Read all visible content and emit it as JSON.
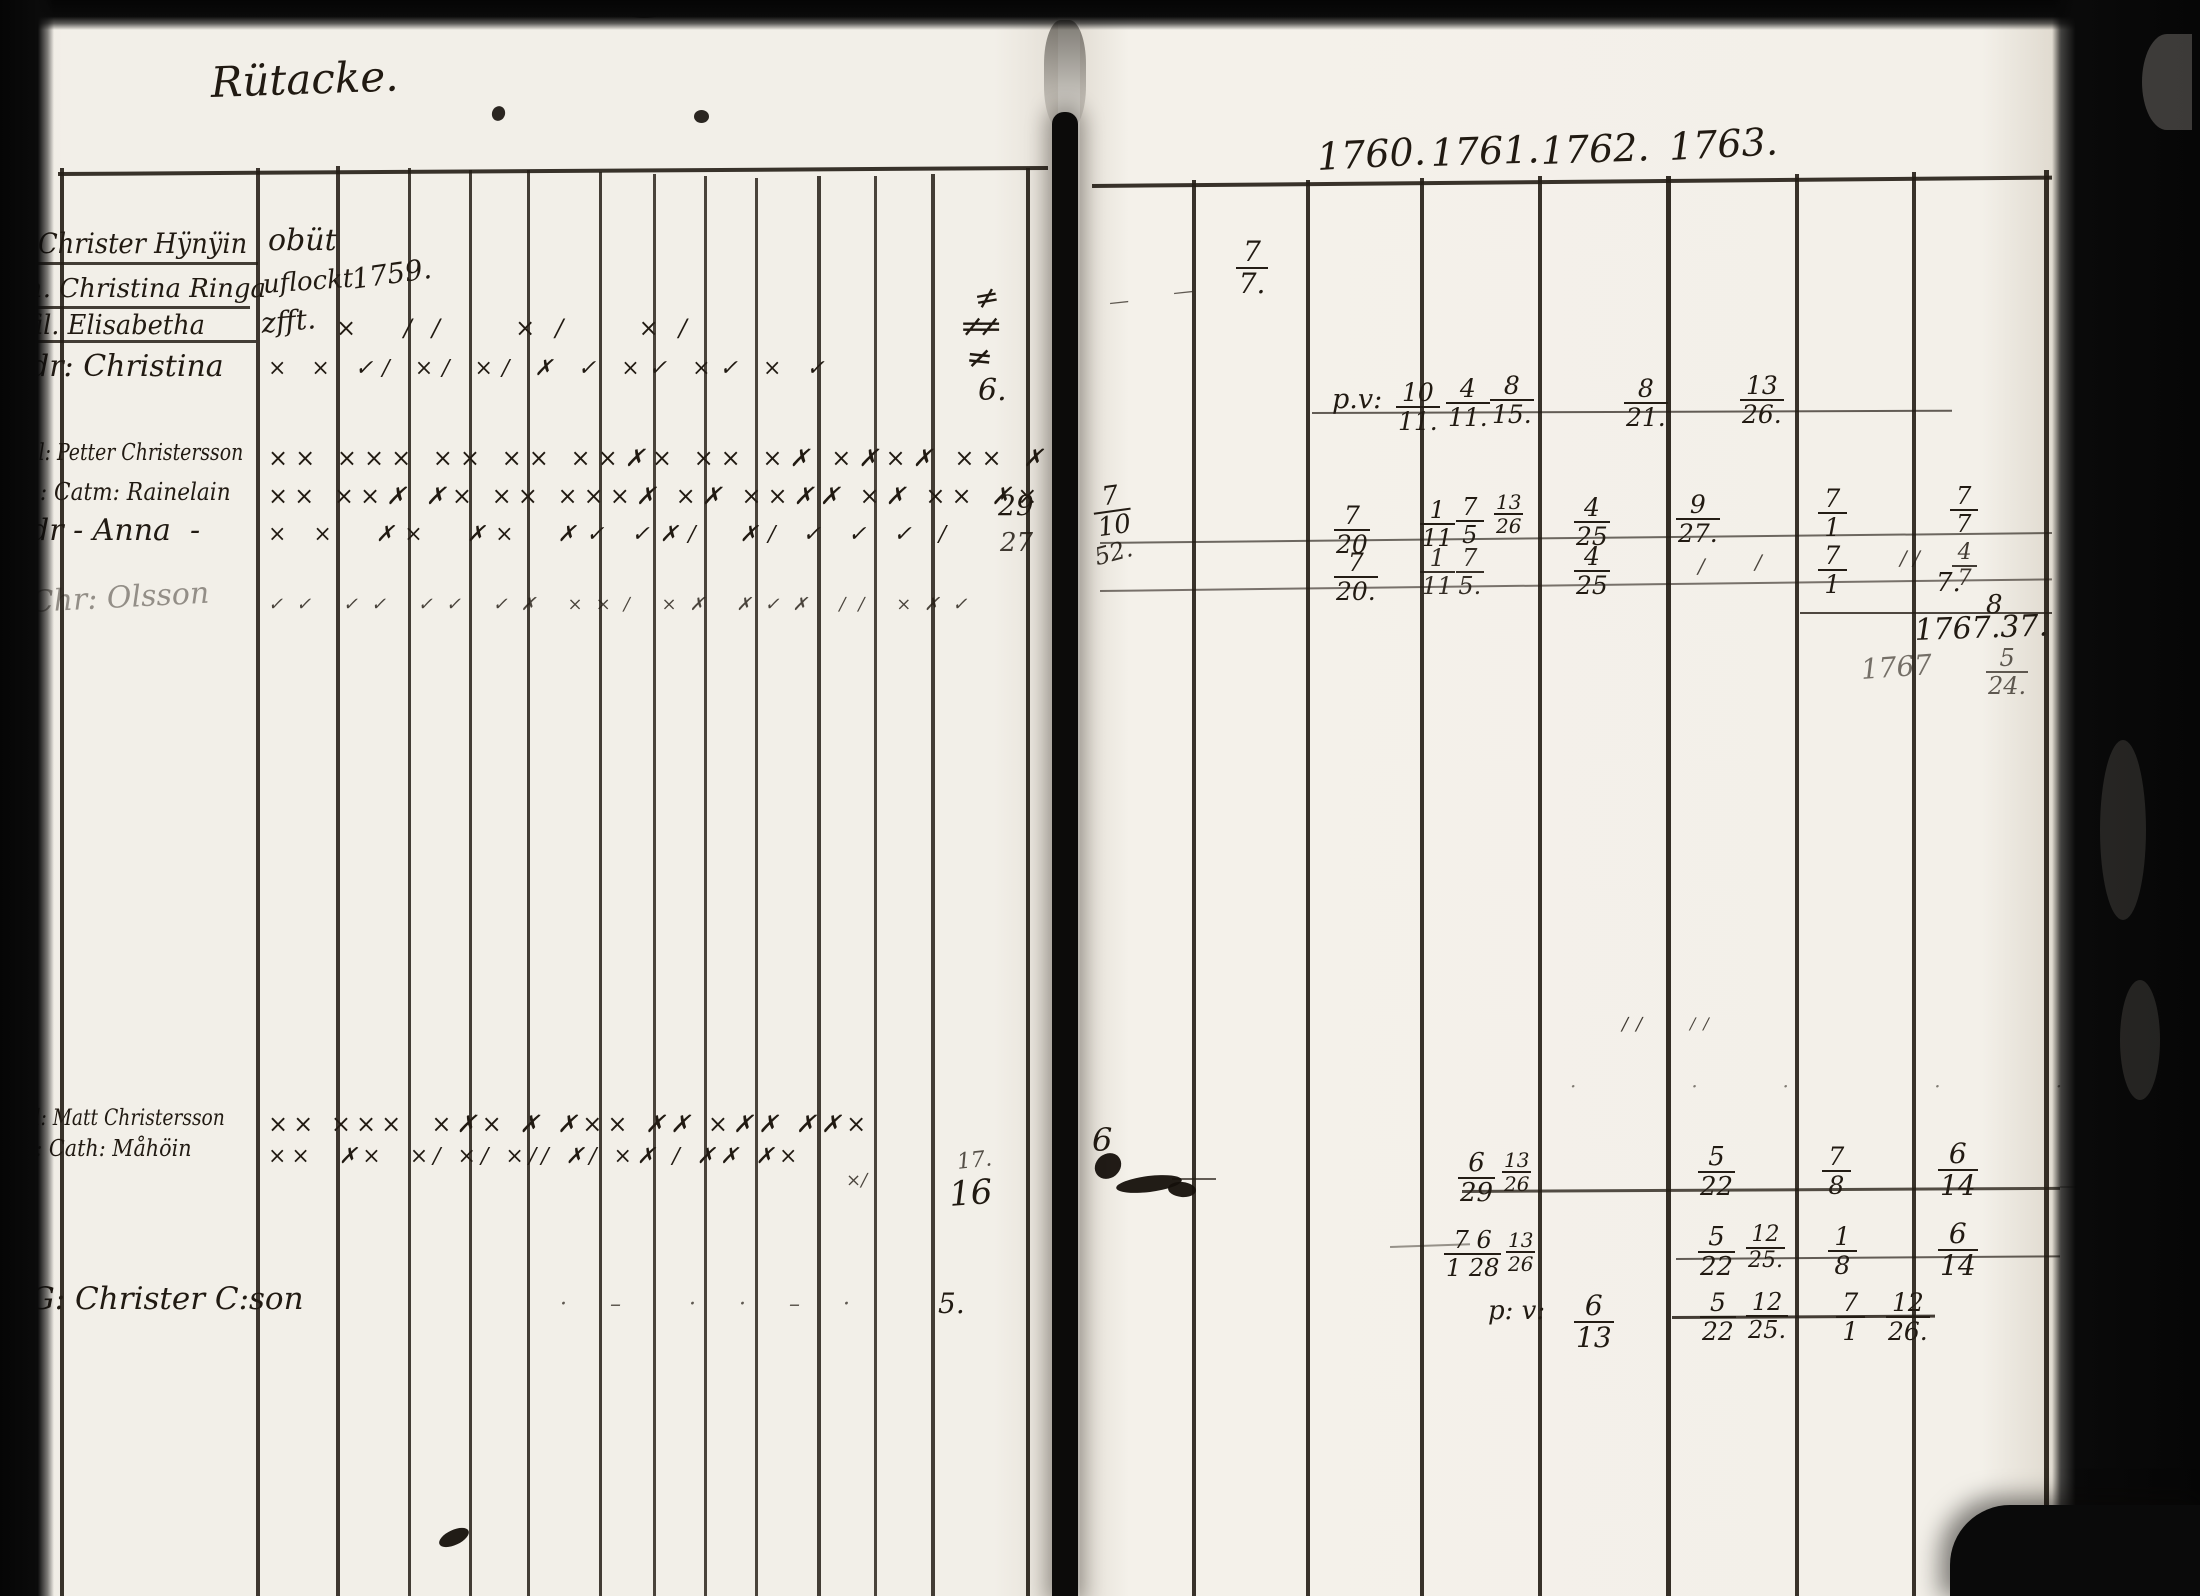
{
  "title": {
    "x": 210,
    "y": 62,
    "text": "Rütacke.",
    "size": 42,
    "rot": -2,
    "name": "page-title"
  },
  "years": [
    {
      "x": 1316,
      "y": 138,
      "text": "1760.",
      "size": 38,
      "rot": -3,
      "name": "year-label"
    },
    {
      "x": 1430,
      "y": 134,
      "text": "1761.",
      "size": 38,
      "rot": -2,
      "name": "year-label"
    },
    {
      "x": 1540,
      "y": 132,
      "text": "1762.",
      "size": 38,
      "rot": -2,
      "name": "year-label"
    },
    {
      "x": 1668,
      "y": 128,
      "text": "1763.",
      "size": 38,
      "rot": -3,
      "name": "year-label"
    }
  ],
  "left_page": {
    "records": [
      {
        "x": 38,
        "y": 230,
        "text": "Christer Hÿnÿin",
        "size": 28,
        "scx": 0.92,
        "name": "record-name"
      },
      {
        "x": 268,
        "y": 226,
        "text": "obüt",
        "size": 30,
        "name": "record-note"
      },
      {
        "x": 26,
        "y": 276,
        "text": "h. Christina Ringa",
        "size": 26,
        "name": "record-name"
      },
      {
        "x": 262,
        "y": 272,
        "text": "uflockt",
        "size": 26,
        "rot": -4,
        "name": "record-note"
      },
      {
        "x": 350,
        "y": 266,
        "text": "1759.",
        "size": 28,
        "rot": -8,
        "name": "record-note"
      },
      {
        "x": 26,
        "y": 312,
        "text": "fil. Elisabetha",
        "size": 27,
        "scx": 0.95,
        "name": "record-name"
      },
      {
        "x": 260,
        "y": 310,
        "text": "zfft.",
        "size": 28,
        "rot": -5,
        "name": "record-note"
      },
      {
        "x": 30,
        "y": 352,
        "text": "dr: Christina",
        "size": 30,
        "name": "record-name"
      },
      {
        "x": 26,
        "y": 442,
        "text": "fil: Petter Christersson",
        "size": 23,
        "scx": 0.82,
        "name": "record-name"
      },
      {
        "x": 26,
        "y": 480,
        "text": "h: Catm: Rainelain",
        "size": 24,
        "scx": 0.9,
        "name": "record-name"
      },
      {
        "x": 30,
        "y": 516,
        "text": "dr - Anna  -",
        "size": 30,
        "name": "record-name"
      },
      {
        "x": 30,
        "y": 588,
        "text": "Chr: Olsson",
        "size": 30,
        "o": 0.45,
        "rot": -3,
        "name": "record-name"
      },
      {
        "x": 22,
        "y": 1108,
        "text": "fil: Matt Christersson",
        "size": 22,
        "scx": 0.85,
        "name": "record-name"
      },
      {
        "x": 22,
        "y": 1138,
        "text": "h: Cath: Måhöin",
        "size": 23,
        "scx": 0.9,
        "name": "record-name"
      },
      {
        "x": 30,
        "y": 1284,
        "text": "G: Christer C:son",
        "size": 31,
        "name": "record-name"
      }
    ],
    "mark_rows": [
      {
        "x": 336,
        "y": 316,
        "text": "× ∕∕  ×∕  ×∕",
        "size": 24,
        "ls": 20,
        "name": "mark-row"
      },
      {
        "x": 268,
        "y": 358,
        "text": "× × ✓∕ ×∕ ×∕ ✗ ✓ ×✓ ×✓ × ✓",
        "size": 22,
        "ls": 9,
        "name": "mark-row"
      },
      {
        "x": 268,
        "y": 446,
        "text": "×× ××× ×× ×× ××✗× ×× ×✗ ×✗×✗ ×× ✗",
        "size": 24,
        "ls": 7,
        "name": "mark-row"
      },
      {
        "x": 268,
        "y": 484,
        "text": "×× ××✗ ✗× ×× ×××✗ ×✗ ××✗✗ ×✗ ×× ✗×",
        "size": 24,
        "ls": 6,
        "name": "mark-row"
      },
      {
        "x": 268,
        "y": 524,
        "text": "× ×  ✗×  ✗×  ✗✓ ✓✗∕  ✗∕ ✓ ✓ ✓ ∕",
        "size": 22,
        "ls": 10,
        "name": "mark-row"
      },
      {
        "x": 268,
        "y": 596,
        "text": "✓✓ ✓✓ ✓✓ ✓✗ ××∕ ×✗ ✗✓✗ ∕∕ ×✗✓",
        "size": 18,
        "ls": 13,
        "o": 0.8,
        "name": "mark-row"
      },
      {
        "x": 268,
        "y": 1112,
        "text": "×× ×××  ×✗× ✗ ✗×× ✗✗ ×✗✗ ✗✗×",
        "size": 24,
        "ls": 5,
        "name": "mark-row"
      },
      {
        "x": 268,
        "y": 1146,
        "text": "××  ✗×  ×∕ ×∕ ×∕∕ ✗∕ ×✗ ∕ ✗✗ ✗×",
        "size": 22,
        "ls": 5,
        "name": "mark-row"
      },
      {
        "x": 846,
        "y": 1172,
        "text": "×∕",
        "size": 18,
        "o": 0.8,
        "name": "mark-row"
      },
      {
        "x": 560,
        "y": 1294,
        "text": "· –  · · – ·",
        "size": 22,
        "ls": 18,
        "o": 0.7,
        "name": "mark-row"
      }
    ],
    "numbers": [
      {
        "x": 972,
        "y": 286,
        "text": "≠",
        "size": 30,
        "rot": -10,
        "name": "tally-mark"
      },
      {
        "x": 960,
        "y": 312,
        "text": "≠≠",
        "size": 30,
        "ls": -8,
        "name": "tally-mark"
      },
      {
        "x": 968,
        "y": 340,
        "text": "≠",
        "size": 32,
        "rot": 6,
        "name": "tally-mark"
      },
      {
        "x": 978,
        "y": 376,
        "text": "6.",
        "size": 30,
        "name": "number"
      },
      {
        "x": 998,
        "y": 492,
        "text": "29",
        "size": 28,
        "name": "number"
      },
      {
        "x": 1000,
        "y": 530,
        "text": "27",
        "size": 26,
        "o": 0.85,
        "name": "number"
      },
      {
        "x": 956,
        "y": 1152,
        "text": "17.",
        "size": 22,
        "o": 0.75,
        "rot": -6,
        "name": "number"
      },
      {
        "x": 948,
        "y": 1178,
        "text": "16",
        "size": 34,
        "rot": -4,
        "name": "number"
      },
      {
        "x": 938,
        "y": 1290,
        "text": "5.",
        "size": 28,
        "name": "number"
      }
    ]
  },
  "right_page": {
    "notes": [
      {
        "x": 1108,
        "y": 292,
        "text": "—",
        "size": 20,
        "rot": -6,
        "o": 0.7,
        "name": "pen-dash"
      },
      {
        "x": 1172,
        "y": 282,
        "text": "—",
        "size": 20,
        "rot": -6,
        "o": 0.7,
        "name": "pen-dash"
      },
      {
        "x": 1332,
        "y": 386,
        "text": "p.v:",
        "size": 27,
        "name": "abbrev-pv"
      },
      {
        "x": 1092,
        "y": 546,
        "text": "52.",
        "size": 24,
        "rot": -15,
        "o": 0.9,
        "name": "number"
      },
      {
        "x": 1698,
        "y": 556,
        "text": "∕",
        "size": 20,
        "o": 0.8,
        "name": "pen-tick"
      },
      {
        "x": 1755,
        "y": 552,
        "text": "∕",
        "size": 20,
        "o": 0.8,
        "name": "pen-tick"
      },
      {
        "x": 1900,
        "y": 548,
        "text": "∕ ∕",
        "size": 20,
        "o": 0.8,
        "name": "pen-tick"
      },
      {
        "x": 1936,
        "y": 570,
        "text": "7.",
        "size": 26,
        "name": "number"
      },
      {
        "x": 1986,
        "y": 592,
        "text": "8",
        "size": 26,
        "name": "number"
      },
      {
        "x": 1914,
        "y": 616,
        "text": "1767.37.",
        "size": 30,
        "rot": -2,
        "name": "year-total"
      },
      {
        "x": 1860,
        "y": 656,
        "text": "1767",
        "size": 28,
        "rot": -4,
        "o": 0.6,
        "name": "year-total"
      },
      {
        "x": 1622,
        "y": 1016,
        "text": "∕∕",
        "size": 18,
        "ls": 8,
        "o": 0.85,
        "name": "pen-tick"
      },
      {
        "x": 1690,
        "y": 1016,
        "text": "∕∕",
        "size": 16,
        "ls": 8,
        "o": 0.8,
        "name": "pen-tick"
      },
      {
        "x": 1570,
        "y": 1076,
        "text": "·   ·  ·    ·   ·  · ·",
        "size": 20,
        "ls": 24,
        "o": 0.55,
        "name": "dot-row"
      },
      {
        "x": 1092,
        "y": 1124,
        "text": "6",
        "size": 32,
        "name": "number"
      },
      {
        "x": 1488,
        "y": 1298,
        "text": "p: v:",
        "size": 26,
        "name": "abbrev-pv"
      }
    ],
    "fractions": [
      {
        "x": 1236,
        "y": 238,
        "num": "7",
        "den": "7.",
        "size": 28,
        "name": "date-fraction"
      },
      {
        "x": 1396,
        "y": 380,
        "num": "10",
        "den": "11.",
        "size": 25,
        "name": "date-fraction"
      },
      {
        "x": 1446,
        "y": 376,
        "num": "4",
        "den": "11.",
        "size": 25,
        "name": "date-fraction"
      },
      {
        "x": 1490,
        "y": 373,
        "num": "8",
        "den": "15.",
        "size": 25,
        "name": "date-fraction"
      },
      {
        "x": 1624,
        "y": 376,
        "num": "8",
        "den": "21.",
        "size": 25,
        "name": "date-fraction"
      },
      {
        "x": 1740,
        "y": 373,
        "num": "13",
        "den": "26.",
        "size": 25,
        "name": "date-fraction"
      },
      {
        "x": 1090,
        "y": 486,
        "num": "7",
        "den": "10",
        "size": 26,
        "rot": -8,
        "name": "date-fraction"
      },
      {
        "x": 1334,
        "y": 503,
        "num": "7",
        "den": "20",
        "size": 25,
        "name": "date-fraction"
      },
      {
        "x": 1420,
        "y": 498,
        "num": "1",
        "den": "11",
        "size": 24,
        "name": "date-fraction"
      },
      {
        "x": 1456,
        "y": 495,
        "num": "7",
        "den": "5",
        "size": 24,
        "name": "date-fraction"
      },
      {
        "x": 1494,
        "y": 492,
        "num": "13",
        "den": "26",
        "size": 20,
        "name": "date-fraction"
      },
      {
        "x": 1574,
        "y": 495,
        "num": "4",
        "den": "25",
        "size": 25,
        "name": "date-fraction"
      },
      {
        "x": 1676,
        "y": 492,
        "num": "9",
        "den": "27.",
        "size": 25,
        "name": "date-fraction"
      },
      {
        "x": 1818,
        "y": 486,
        "num": "7",
        "den": "1",
        "size": 25,
        "name": "date-fraction"
      },
      {
        "x": 1950,
        "y": 484,
        "num": "7",
        "den": "7",
        "size": 24,
        "name": "date-fraction"
      },
      {
        "x": 1334,
        "y": 550,
        "num": "7",
        "den": "20.",
        "size": 25,
        "name": "date-fraction"
      },
      {
        "x": 1420,
        "y": 546,
        "num": "1",
        "den": "11",
        "size": 24,
        "o": 0.9,
        "name": "date-fraction"
      },
      {
        "x": 1456,
        "y": 546,
        "num": "7",
        "den": "5.",
        "size": 24,
        "o": 0.9,
        "name": "date-fraction"
      },
      {
        "x": 1574,
        "y": 544,
        "num": "4",
        "den": "25",
        "size": 25,
        "name": "date-fraction"
      },
      {
        "x": 1818,
        "y": 543,
        "num": "7",
        "den": "1",
        "size": 25,
        "name": "date-fraction"
      },
      {
        "x": 1952,
        "y": 542,
        "num": "4",
        "den": "7",
        "size": 22,
        "o": 0.85,
        "name": "date-fraction"
      },
      {
        "x": 1986,
        "y": 646,
        "num": "5",
        "den": "24.",
        "size": 24,
        "o": 0.7,
        "name": "date-fraction"
      },
      {
        "x": 1458,
        "y": 1150,
        "num": "6",
        "den": "29",
        "size": 26,
        "name": "date-fraction"
      },
      {
        "x": 1502,
        "y": 1150,
        "num": "13",
        "den": "26",
        "size": 20,
        "name": "date-fraction"
      },
      {
        "x": 1698,
        "y": 1144,
        "num": "5",
        "den": "22",
        "size": 26,
        "name": "date-fraction"
      },
      {
        "x": 1822,
        "y": 1144,
        "num": "7",
        "den": "8",
        "size": 25,
        "name": "date-fraction"
      },
      {
        "x": 1938,
        "y": 1140,
        "num": "6",
        "den": "14",
        "size": 28,
        "name": "date-fraction"
      },
      {
        "x": 1444,
        "y": 1228,
        "num": "7 6",
        "den": "1 28",
        "size": 24,
        "name": "date-fraction"
      },
      {
        "x": 1506,
        "y": 1230,
        "num": "13",
        "den": "26",
        "size": 20,
        "name": "date-fraction"
      },
      {
        "x": 1698,
        "y": 1224,
        "num": "5",
        "den": "22",
        "size": 26,
        "name": "date-fraction"
      },
      {
        "x": 1746,
        "y": 1224,
        "num": "12",
        "den": "25.",
        "size": 22,
        "name": "date-fraction"
      },
      {
        "x": 1828,
        "y": 1224,
        "num": "1",
        "den": "8",
        "size": 25,
        "name": "date-fraction"
      },
      {
        "x": 1938,
        "y": 1220,
        "num": "6",
        "den": "14",
        "size": 28,
        "name": "date-fraction"
      },
      {
        "x": 1574,
        "y": 1292,
        "num": "6",
        "den": "13",
        "size": 28,
        "name": "date-fraction"
      },
      {
        "x": 1700,
        "y": 1290,
        "num": "5",
        "den": "22",
        "size": 25,
        "name": "date-fraction"
      },
      {
        "x": 1746,
        "y": 1290,
        "num": "12",
        "den": "25.",
        "size": 24,
        "name": "date-fraction"
      },
      {
        "x": 1836,
        "y": 1290,
        "num": "7",
        "den": "1",
        "size": 25,
        "name": "date-fraction"
      },
      {
        "x": 1886,
        "y": 1290,
        "num": "12",
        "den": "26.",
        "size": 25,
        "name": "date-fraction"
      }
    ]
  },
  "grid": {
    "vlines": [
      {
        "x": 60,
        "y1": 168,
        "y2": 1596,
        "w": 4,
        "o": 0.9
      },
      {
        "x": 256,
        "y1": 168,
        "y2": 1596,
        "w": 3.5,
        "o": 0.88
      },
      {
        "x": 336,
        "y1": 166,
        "y2": 1596,
        "w": 3.5,
        "o": 0.88
      },
      {
        "x": 408,
        "y1": 168,
        "y2": 1596,
        "w": 3,
        "o": 0.85
      },
      {
        "x": 469,
        "y1": 170,
        "y2": 1596,
        "w": 3,
        "o": 0.85
      },
      {
        "x": 527,
        "y1": 170,
        "y2": 1596,
        "w": 3,
        "o": 0.85
      },
      {
        "x": 599,
        "y1": 172,
        "y2": 1596,
        "w": 3,
        "o": 0.85
      },
      {
        "x": 653,
        "y1": 174,
        "y2": 1596,
        "w": 3,
        "o": 0.82
      },
      {
        "x": 704,
        "y1": 176,
        "y2": 1596,
        "w": 3,
        "o": 0.82
      },
      {
        "x": 755,
        "y1": 178,
        "y2": 1596,
        "w": 3,
        "o": 0.82
      },
      {
        "x": 817,
        "y1": 176,
        "y2": 1596,
        "w": 3.5,
        "o": 0.85
      },
      {
        "x": 874,
        "y1": 176,
        "y2": 1596,
        "w": 3,
        "o": 0.82
      },
      {
        "x": 931,
        "y1": 174,
        "y2": 1596,
        "w": 3.5,
        "o": 0.85
      },
      {
        "x": 1026,
        "y1": 168,
        "y2": 1596,
        "w": 4,
        "o": 0.9
      },
      {
        "x": 1192,
        "y1": 180,
        "y2": 1596,
        "w": 4,
        "o": 0.9
      },
      {
        "x": 1306,
        "y1": 180,
        "y2": 1596,
        "w": 4,
        "o": 0.9
      },
      {
        "x": 1420,
        "y1": 178,
        "y2": 1596,
        "w": 4,
        "o": 0.9
      },
      {
        "x": 1538,
        "y1": 176,
        "y2": 1596,
        "w": 4,
        "o": 0.9
      },
      {
        "x": 1666,
        "y1": 176,
        "y2": 1596,
        "w": 4.5,
        "o": 0.92
      },
      {
        "x": 1795,
        "y1": 174,
        "y2": 1596,
        "w": 4,
        "o": 0.9
      },
      {
        "x": 1912,
        "y1": 172,
        "y2": 1596,
        "w": 4,
        "o": 0.9
      },
      {
        "x": 2044,
        "y1": 170,
        "y2": 1596,
        "w": 5,
        "o": 0.92
      }
    ],
    "hlines": [
      {
        "x1": 58,
        "x2": 1048,
        "y": 172,
        "w": 4,
        "o": 0.9,
        "rot": -0.35,
        "name": "table-top-rule"
      },
      {
        "x1": 1092,
        "x2": 2052,
        "y": 184,
        "w": 4,
        "o": 0.9,
        "rot": -0.5,
        "name": "table-top-rule"
      },
      {
        "x1": 30,
        "x2": 258,
        "y": 262,
        "w": 3,
        "o": 0.85,
        "rot": 0,
        "name": "name-underline"
      },
      {
        "x1": 26,
        "x2": 250,
        "y": 306,
        "w": 3,
        "o": 0.85,
        "rot": 0,
        "name": "name-underline"
      },
      {
        "x1": 26,
        "x2": 256,
        "y": 340,
        "w": 3,
        "o": 0.85,
        "rot": 0,
        "name": "name-underline"
      },
      {
        "x1": 1312,
        "x2": 1952,
        "y": 412,
        "w": 2,
        "o": 0.7,
        "rot": -0.2,
        "name": "entry-rule"
      },
      {
        "x1": 1100,
        "x2": 2052,
        "y": 542,
        "w": 2,
        "o": 0.65,
        "rot": -0.6,
        "name": "entry-rule"
      },
      {
        "x1": 1100,
        "x2": 2052,
        "y": 590,
        "w": 2,
        "o": 0.6,
        "rot": -0.7,
        "name": "entry-rule"
      },
      {
        "x1": 1800,
        "x2": 2052,
        "y": 612,
        "w": 2,
        "o": 0.8,
        "rot": 0,
        "name": "entry-rule"
      },
      {
        "x1": 1462,
        "x2": 2060,
        "y": 1190,
        "w": 2.5,
        "o": 0.78,
        "rot": -0.3,
        "name": "entry-rule"
      },
      {
        "x1": 2060,
        "x2": 2190,
        "y": 1186,
        "w": 2,
        "o": 0.35,
        "rot": 0,
        "name": "entry-rule"
      },
      {
        "x1": 1676,
        "x2": 2060,
        "y": 1258,
        "w": 2,
        "o": 0.7,
        "rot": -0.4,
        "name": "entry-rule"
      },
      {
        "x1": 1390,
        "x2": 1470,
        "y": 1246,
        "w": 1.5,
        "o": 0.45,
        "rot": -2,
        "name": "entry-rule"
      },
      {
        "x1": 1672,
        "x2": 1935,
        "y": 1316,
        "w": 2.5,
        "o": 0.85,
        "rot": -0.3,
        "name": "entry-rule"
      },
      {
        "x1": 1172,
        "x2": 1216,
        "y": 1178,
        "w": 2,
        "o": 0.7,
        "rot": 0,
        "name": "pen-tick"
      }
    ]
  },
  "blots": [
    {
      "x": 438,
      "y": 1530,
      "w": 32,
      "h": 15,
      "rot": -25,
      "o": 0.95
    },
    {
      "x": 1094,
      "y": 1154,
      "w": 28,
      "h": 24,
      "rot": -40,
      "o": 0.95
    },
    {
      "x": 1116,
      "y": 1176,
      "w": 66,
      "h": 16,
      "rot": -7,
      "o": 0.95
    },
    {
      "x": 1168,
      "y": 1182,
      "w": 28,
      "h": 15,
      "rot": 5,
      "o": 0.95
    },
    {
      "x": 694,
      "y": 110,
      "w": 15,
      "h": 13,
      "rot": 0,
      "o": 0.9
    },
    {
      "x": 492,
      "y": 106,
      "w": 13,
      "h": 15,
      "rot": 20,
      "o": 0.9
    },
    {
      "x": 624,
      "y": 4,
      "w": 40,
      "h": 14,
      "rot": 0,
      "o": 0.8
    }
  ]
}
